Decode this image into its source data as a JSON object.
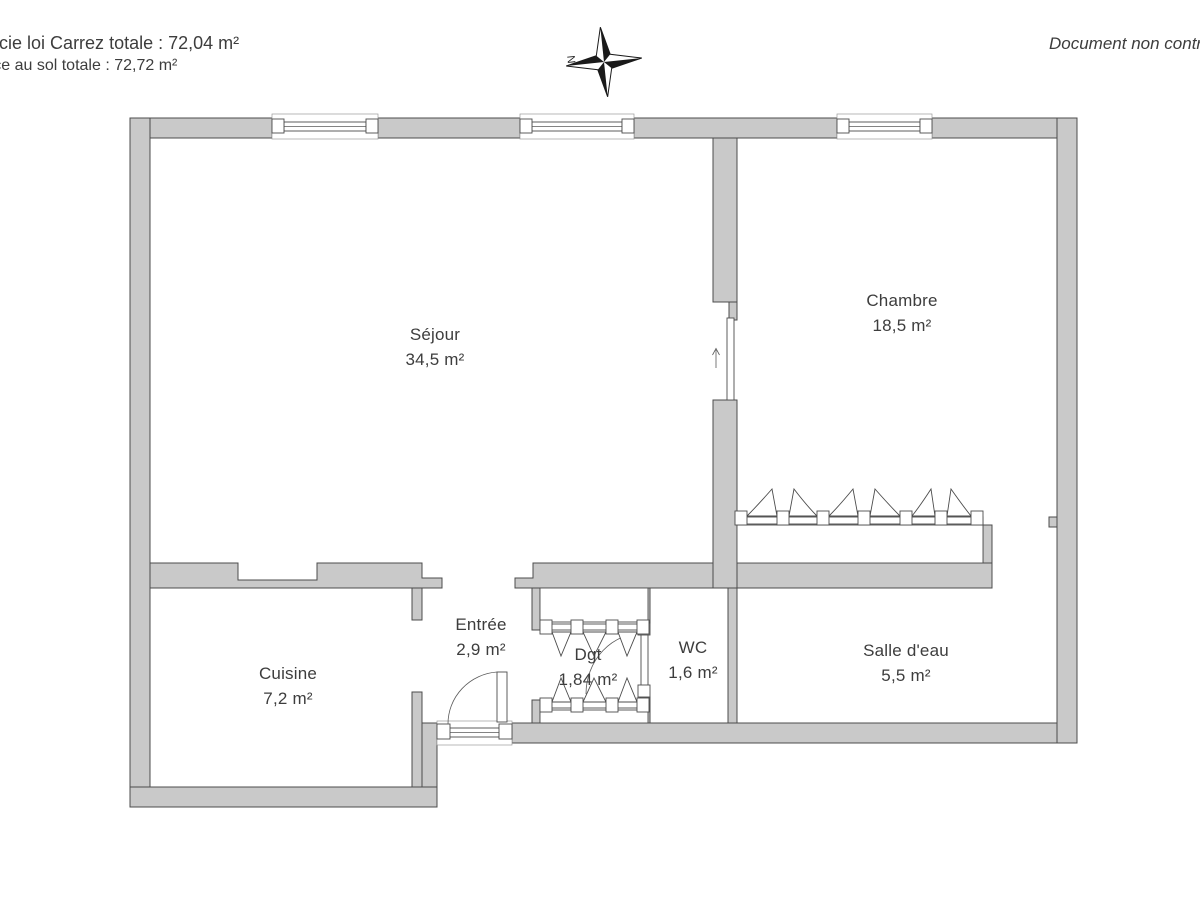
{
  "header": {
    "carrez_text": "Superficie loi Carrez totale :  72,04 m²",
    "floor_text": "Surface au sol totale :  72,72 m²",
    "disclaimer_text": "Document non contractuel",
    "north_label": "N"
  },
  "rooms": {
    "sejour": {
      "name": "Séjour",
      "area": "34,5 m²"
    },
    "chambre": {
      "name": "Chambre",
      "area": "18,5 m²"
    },
    "cuisine": {
      "name": "Cuisine",
      "area": "7,2 m²"
    },
    "entree": {
      "name": "Entrée",
      "area": "2,9 m²"
    },
    "degagement": {
      "name": "Dgt",
      "area": "1,84 m²"
    },
    "wc": {
      "name": "WC",
      "area": "1,6 m²"
    },
    "salle_eau": {
      "name": "Salle d'eau",
      "area": "5,5 m²"
    }
  },
  "colors": {
    "wall_fill": "#c9c9c9",
    "wall_outline": "#4c4c4c",
    "text": "#3d3d3d"
  }
}
